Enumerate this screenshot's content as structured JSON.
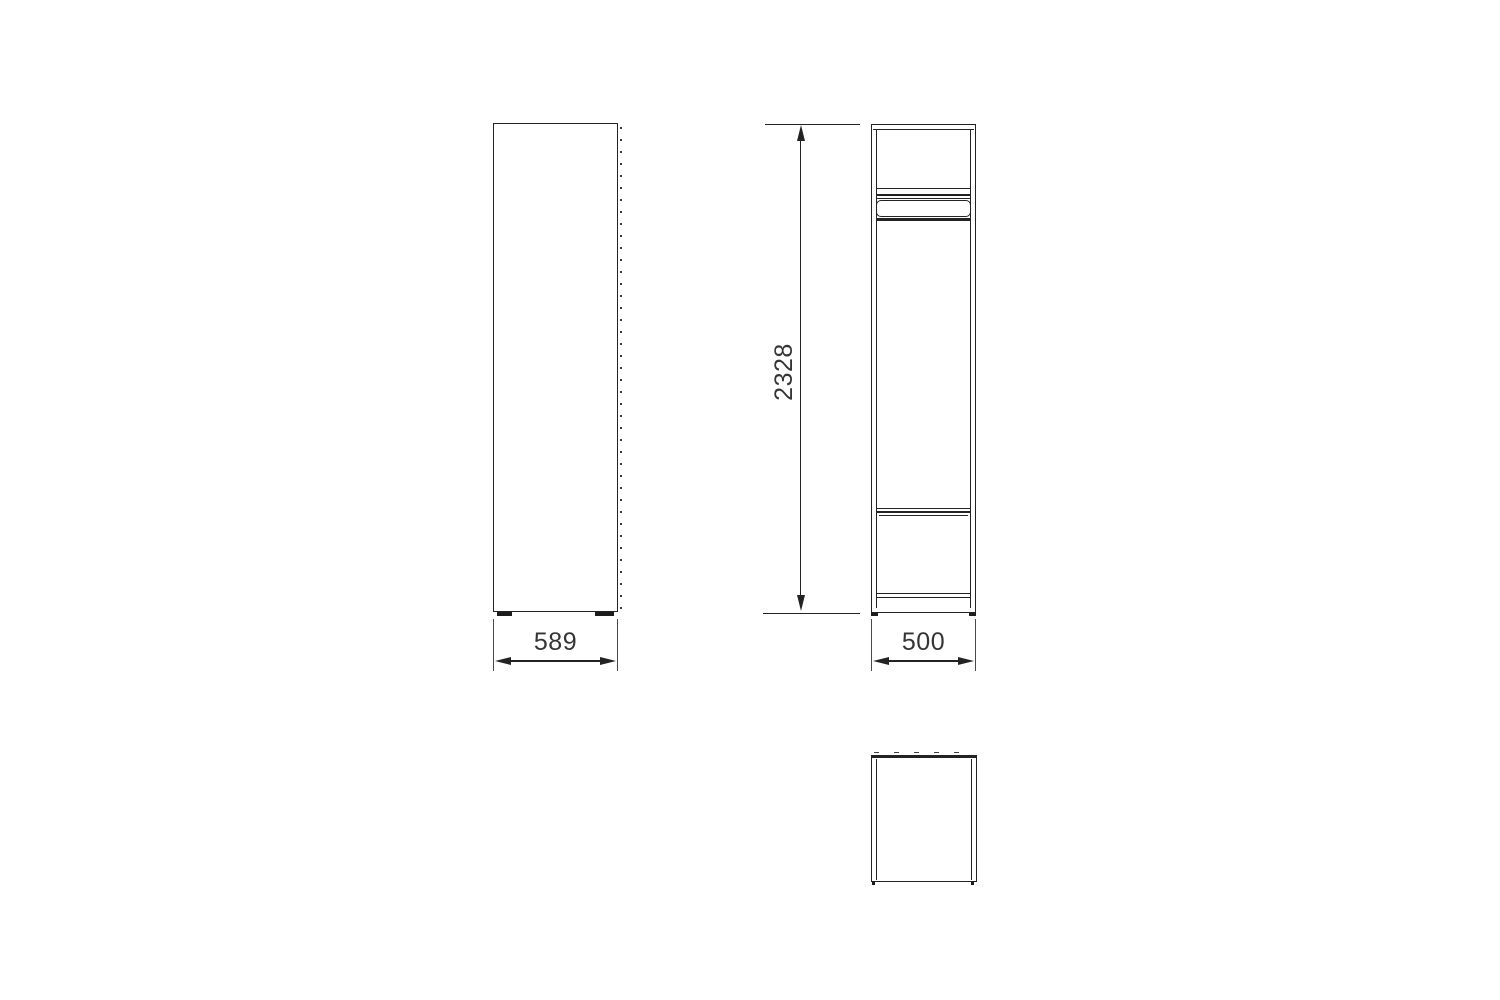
{
  "drawing": {
    "type": "furniture-orthographic-technical-drawing",
    "views": {
      "front": "front-view",
      "side": "side-view",
      "top": "top-view"
    },
    "dimensions": {
      "front_width": "589",
      "height": "2328",
      "depth": "500"
    },
    "colors": {
      "background": "#ffffff",
      "line": "#232323",
      "extension_line": "#4a4a4a",
      "text": "#353535"
    }
  }
}
